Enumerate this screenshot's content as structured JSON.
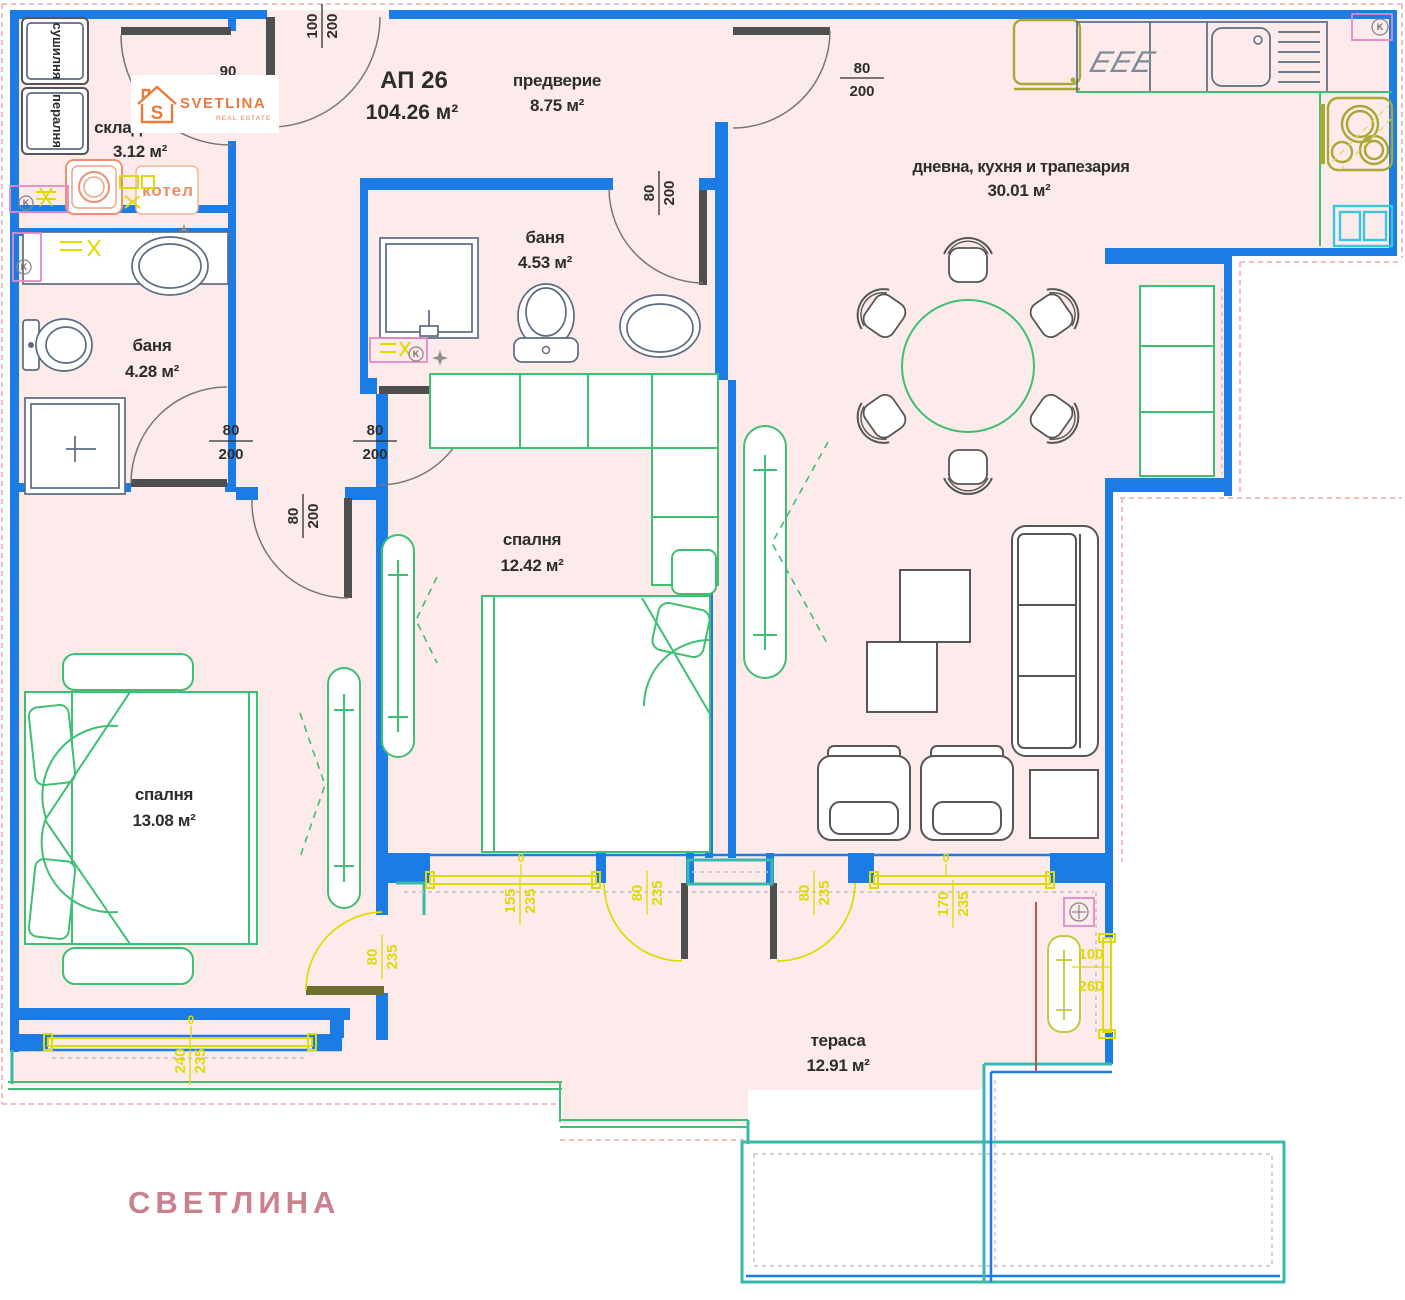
{
  "title": {
    "unit": "АП 26",
    "area": "104.26 м²"
  },
  "rooms": {
    "hallway": {
      "name": "предверие",
      "area": "8.75 м²"
    },
    "living": {
      "name": "дневна, кухня и трапезария",
      "area": "30.01 м²"
    },
    "bath1": {
      "name": "баня",
      "area": "4.28 м²"
    },
    "bath2": {
      "name": "баня",
      "area": "4.53 м²"
    },
    "bed1": {
      "name": "спалня",
      "area": "13.08 м²"
    },
    "bed2": {
      "name": "спалня",
      "area": "12.42 м²"
    },
    "terrace": {
      "name": "тераса",
      "area": "12.91 м²"
    },
    "storage": {
      "name": "склад",
      "area": "3.12 м²"
    }
  },
  "appliances": {
    "dryer": "сушилня",
    "washer": "пералня",
    "boiler": "котел"
  },
  "door_dims": {
    "entry": "90",
    "storage": {
      "num": "100",
      "den": "200"
    },
    "hall_living": {
      "num": "80",
      "den": "200"
    },
    "bath2": {
      "num": "80",
      "den": "200"
    },
    "bath1": {
      "num": "80",
      "den": "200"
    },
    "bed2": {
      "num": "80",
      "den": "200"
    },
    "bed1": {
      "num": "80",
      "den": "200"
    }
  },
  "window_dims": {
    "w155": {
      "num": "155",
      "den": "235"
    },
    "door_a": {
      "num": "80",
      "den": "235"
    },
    "door_b": {
      "num": "80",
      "den": "235"
    },
    "w170": {
      "num": "170",
      "den": "235"
    },
    "w100": {
      "num": "100",
      "den": "260"
    },
    "w240": {
      "num": "240",
      "den": "235"
    },
    "bed1_door": {
      "num": "80",
      "den": "235"
    },
    "zero": "0"
  },
  "logo": {
    "brand": "SVETLINA",
    "tagline": "REAL ESTATE",
    "letter": "S"
  },
  "watermark": "СВЕТЛИНА",
  "icons": {
    "stove": "EEE",
    "vent": "K"
  },
  "colors": {
    "wall": "#1b7ce6",
    "terrace": "#3ab8ab",
    "window": "#dedb00",
    "furniture": "#3fbf72",
    "appliance": "#a8a838",
    "brand": "#e87a3c",
    "floor": "#fcebea",
    "watermark": "#c9818d"
  }
}
